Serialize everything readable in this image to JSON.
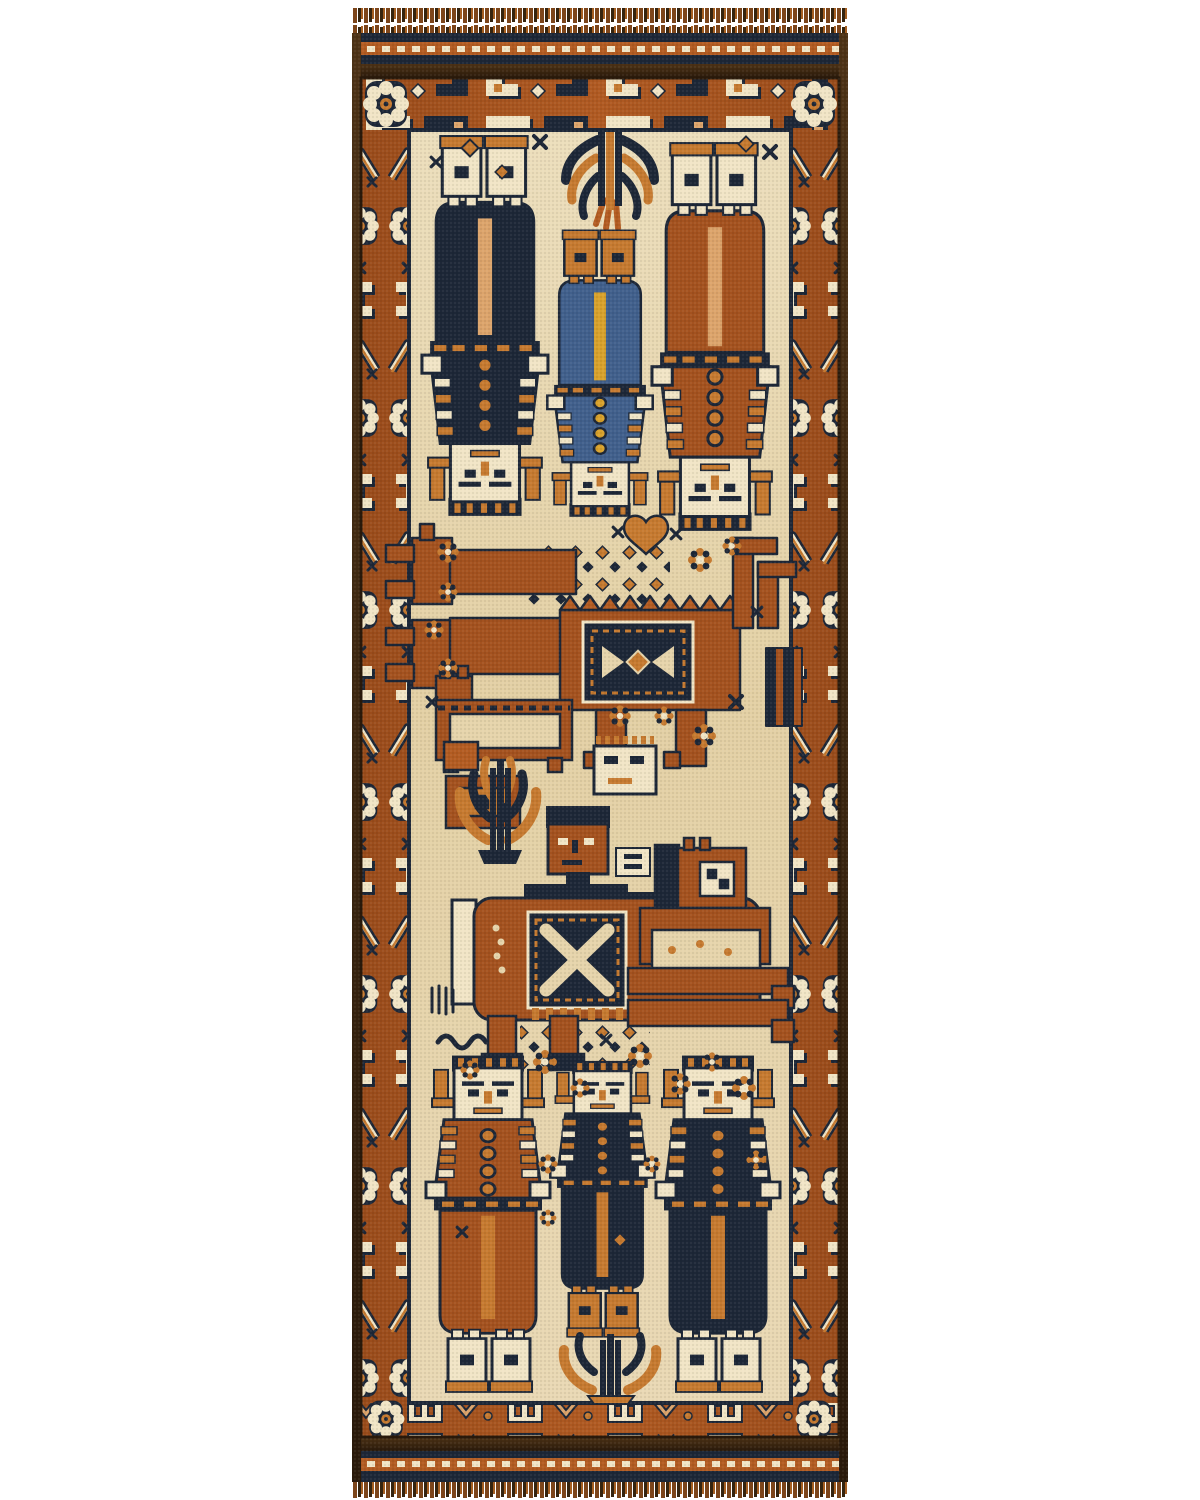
{
  "scene": {
    "type": "product-photograph",
    "subject": "hand-knotted tribal pictorial runner rug",
    "style": "Afghan Baluch pictorial runner with human figures and animals",
    "background": "plain white studio backdrop",
    "orientation": "vertical runner, fringe at both ends"
  },
  "palette": {
    "white": "#ffffff",
    "rust": "#a4521f",
    "rust2": "#b35c22",
    "orange": "#c67a30",
    "peach": "#dca46b",
    "cream": "#e6d4ab",
    "ivory": "#f1e5c6",
    "navy": "#1d2737",
    "navy2": "#2c3a52",
    "blue": "#41608c",
    "brown": "#4e3316",
    "darkbrown": "#2a1a0b",
    "gold": "#d9a22c"
  },
  "rug": {
    "ends": {
      "top": "short wool fringe over striped flat-woven kilim band (navy / rust with white twining / navy / dark brown)",
      "bottom": "striped flat-woven kilim band with white twining and short fringe",
      "sides": "dark goat-hair overcast selvedge"
    },
    "border": {
      "ground_color_name": "rust",
      "motifs": [
        "hooked Z and E devices in cream and navy",
        "white dotted cluster rosettes",
        "eight-petal rosettes",
        "stepped zigzag chevrons",
        "small navy stars"
      ]
    },
    "field": {
      "ground_color_name": "ivory-cream",
      "human_figures_total": 7,
      "animals_total": 4,
      "trees_total": 3,
      "sections": [
        {
          "position": "top",
          "content": "three standing figures woven upside-down (navy coat, blue coat, rust coat) with white square faces, drooping tree motif between their feet"
        },
        {
          "position": "middle",
          "content": "long-necked rust stag with two hooked heads, crenellated saddle panel with navy X-medallion, striped tail, platform motif, small white face-box"
        },
        {
          "position": "lower-middle",
          "content": "rider with rust square face on rust horse wearing navy X saddle blanket; companion rust animal with tower head and white face panel"
        },
        {
          "position": "bottom",
          "content": "three standing figures (rust coat, navy coat, navy coat) with white square faces, buttoned coats, belts and boots; flowering plant between the centre figure's boots"
        }
      ],
      "filler_motifs": "scattered rosettes, diamond dot-grids, hearts, sprigs, S-hooks and stars"
    }
  }
}
